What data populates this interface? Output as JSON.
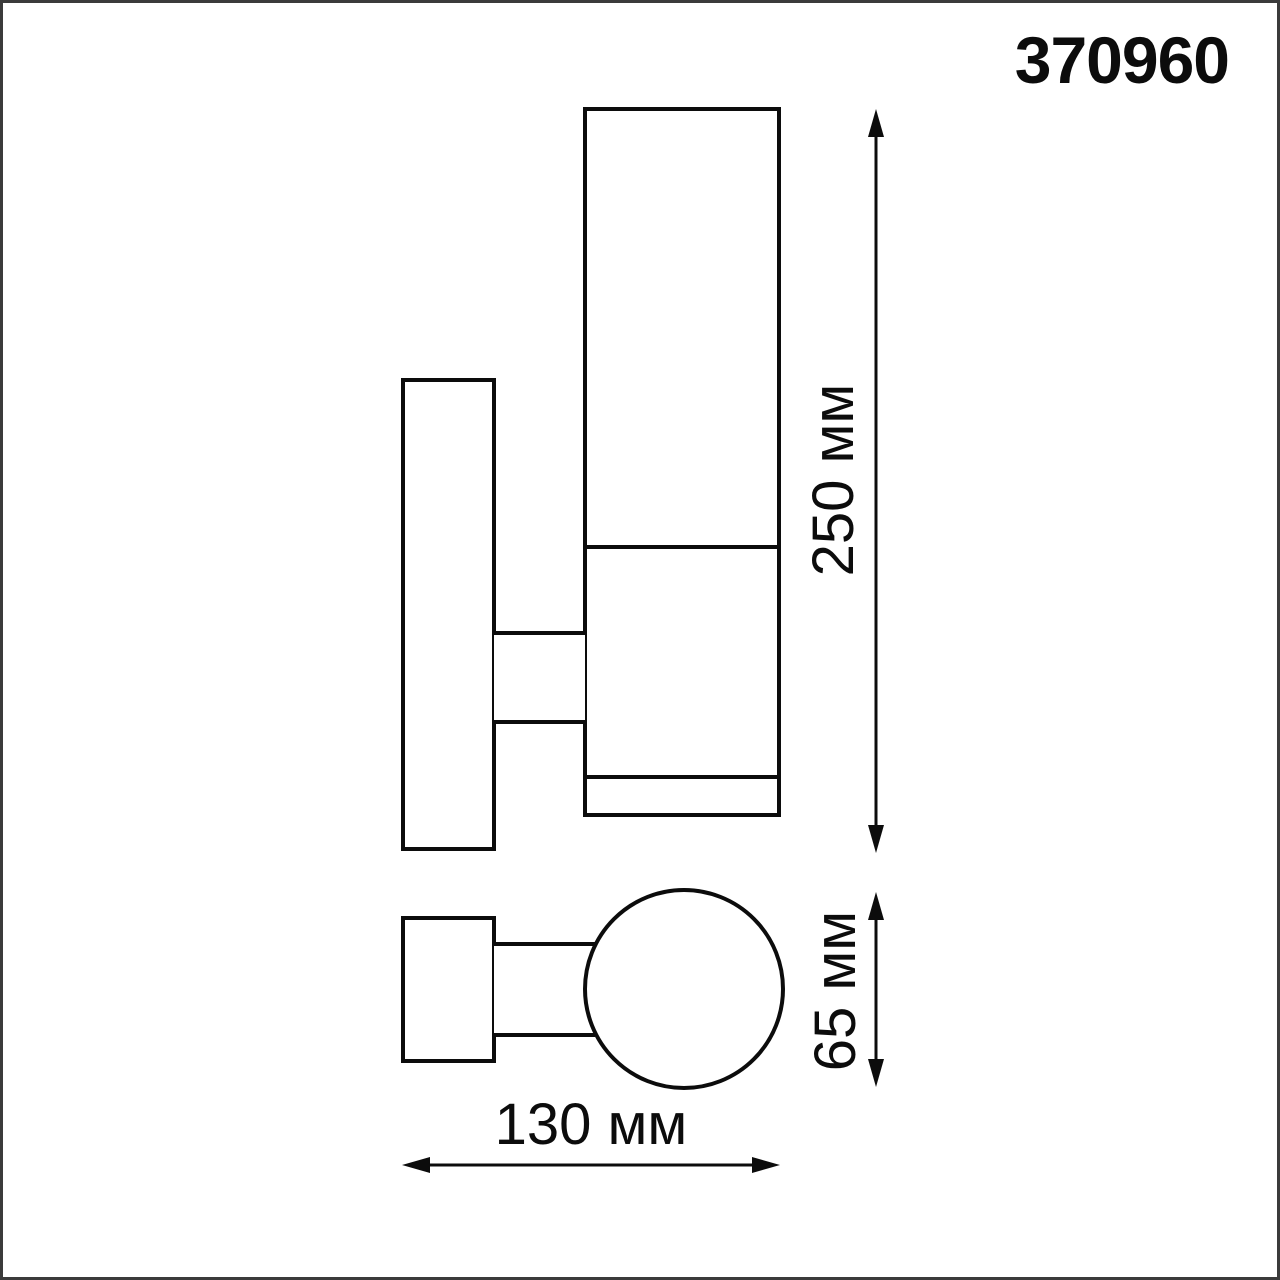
{
  "product_number": "370960",
  "dimensions": {
    "height_label": "250 мм",
    "depth_label": "65 мм",
    "width_label": "130 мм"
  },
  "colors": {
    "background": "#ffffff",
    "frame": "#3b3b3b",
    "line": "#0c0c0c",
    "text": "#0c0c0c"
  }
}
